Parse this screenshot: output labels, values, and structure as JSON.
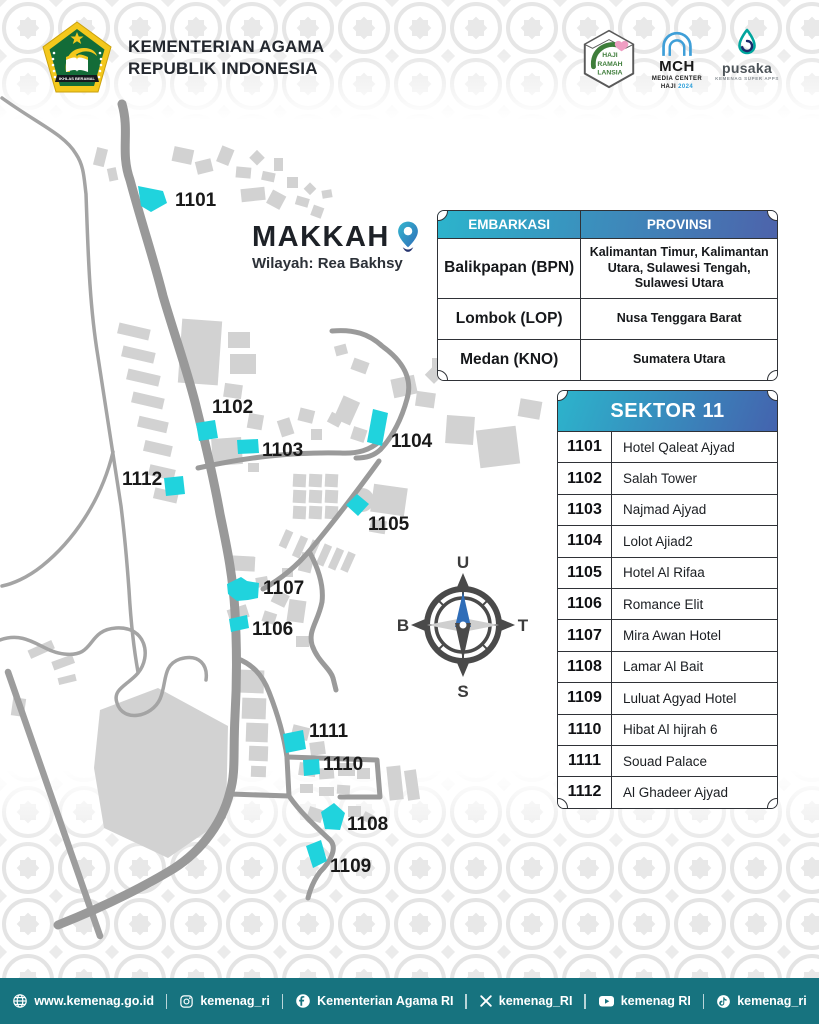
{
  "header": {
    "line1": "KEMENTERIAN AGAMA",
    "line2": "REPUBLIK INDONESIA",
    "logo_banner": "IKHLAS BERAMAL",
    "logos": {
      "hrl": {
        "line1": "HAJI",
        "line2": "RAMAH",
        "line3": "LANSIA"
      },
      "mch": {
        "abbr": "MCH",
        "line1": "MEDIA CENTER",
        "line2": "HAJI",
        "year": "2024"
      },
      "pusaka": {
        "name": "pusaka",
        "tagline": "KEMENAG SUPER APPS"
      }
    }
  },
  "map": {
    "title": "MAKKAH",
    "subtitle": "Wilayah: Rea Bakhsy",
    "marker_color": "#20d3dd",
    "markers": [
      {
        "id": "1101"
      },
      {
        "id": "1102"
      },
      {
        "id": "1103"
      },
      {
        "id": "1104"
      },
      {
        "id": "1105"
      },
      {
        "id": "1106"
      },
      {
        "id": "1107"
      },
      {
        "id": "1108"
      },
      {
        "id": "1109"
      },
      {
        "id": "1110"
      },
      {
        "id": "1111"
      },
      {
        "id": "1112"
      }
    ]
  },
  "compass": {
    "north": "U",
    "east": "T",
    "south": "S",
    "west": "B"
  },
  "embarkasi_table": {
    "headers": [
      "EMBARKASI",
      "PROVINSI"
    ],
    "rows": [
      {
        "embarkasi": "Balikpapan (BPN)",
        "provinsi": "Kalimantan Timur, Kalimantan Utara, Sulawesi Tengah, Sulawesi Utara"
      },
      {
        "embarkasi": "Lombok (LOP)",
        "provinsi": "Nusa Tenggara Barat"
      },
      {
        "embarkasi": "Medan (KNO)",
        "provinsi": "Sumatera Utara"
      }
    ]
  },
  "sektor_table": {
    "title": "SEKTOR 11",
    "rows": [
      {
        "code": "1101",
        "name": "Hotel Qaleat Ajyad"
      },
      {
        "code": "1102",
        "name": "Salah Tower"
      },
      {
        "code": "1103",
        "name": "Najmad Ajyad"
      },
      {
        "code": "1104",
        "name": "Lolot Ajiad2"
      },
      {
        "code": "1105",
        "name": "Hotel Al Rifaa"
      },
      {
        "code": "1106",
        "name": "Romance Elit"
      },
      {
        "code": "1107",
        "name": "Mira Awan Hotel"
      },
      {
        "code": "1108",
        "name": "Lamar Al Bait"
      },
      {
        "code": "1109",
        "name": "Luluat Agyad Hotel"
      },
      {
        "code": "1110",
        "name": "Hibat Al hijrah 6"
      },
      {
        "code": "1111",
        "name": "Souad Palace"
      },
      {
        "code": "1112",
        "name": "Al Ghadeer Ajyad"
      }
    ]
  },
  "footer": {
    "website": "www.kemenag.go.id",
    "instagram": "kemenag_ri",
    "facebook": "Kementerian Agama RI",
    "x": "kemenag_RI",
    "youtube": "kemenag RI",
    "tiktok": "kemenag_ri"
  },
  "colors": {
    "marker_cyan": "#20d3dd",
    "table_gradient_start": "#2cb4cc",
    "table_gradient_end": "#4d63ab",
    "footer_teal": "#17737f",
    "road_gray": "#999999",
    "building_gray": "#d2d2d2"
  }
}
